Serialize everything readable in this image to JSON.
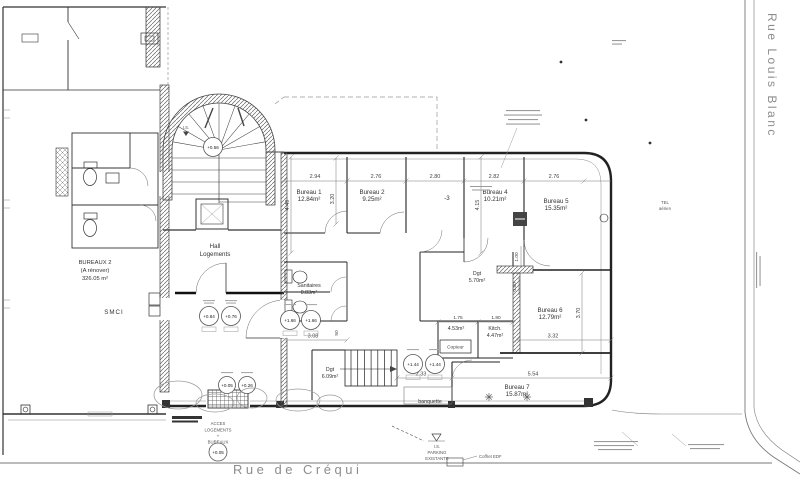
{
  "plan": {
    "streets": {
      "right": "Rue Louis Blanc",
      "bottom": "Rue de Créqui"
    },
    "rooms": {
      "bureau1": {
        "name": "Bureau 1",
        "area": "12.84m²"
      },
      "bureau2": {
        "name": "Bureau 2",
        "area": "9.25m²"
      },
      "bureau3": {
        "name": "-3"
      },
      "bureau4": {
        "name": "Bureau 4",
        "area": "10.21m²"
      },
      "bureau5": {
        "name": "Bureau 5",
        "area": "15.35m²"
      },
      "bureau6": {
        "name": "Bureau 6",
        "area": "12.79m²"
      },
      "bureau7": {
        "name": "Bureau 7",
        "area": "15.87m²"
      },
      "hall": {
        "name": "Hall",
        "name2": "Logements"
      },
      "bureaux2": {
        "name": "BUREAUX 2",
        "status": "(A rénover)",
        "area": "326.05 m²"
      },
      "smci": {
        "name": "SMCI"
      },
      "sanitaires": {
        "name": "Sanitaires",
        "area": "8.83m²"
      },
      "dgt_upper": {
        "name": "Dgt",
        "area": "5.70m²"
      },
      "dgt_lower": {
        "name": "Dgt",
        "area": "6.09m²"
      },
      "kitch": {
        "name": "Kitch.",
        "area": "4.47m²"
      },
      "storage": {
        "area": "4.53m²"
      },
      "copieur": {
        "name": "Copieur"
      },
      "banquette": {
        "name": "banquette"
      }
    },
    "entrance": {
      "l1": "ACCES",
      "l2": "LOGEMENTS",
      "l3": "+",
      "l4": "BUREAUX"
    },
    "parking": {
      "l1": "I.S.",
      "l2": "PARKING",
      "l3": "EXISTANTE"
    },
    "notes": {
      "is": "I.S.",
      "tel1": "TEL",
      "tel2": "aérien",
      "coffret": "Coffret EDF"
    },
    "dims": {
      "top": [
        "2.94",
        "2.76",
        "2.80",
        "2.82",
        "2.76"
      ],
      "v449": "4.49",
      "v320": "3.20",
      "v415": "4.15",
      "v100": "1.00",
      "v080": "0.80",
      "v370": "3.70",
      "h175": "1.75",
      "h180": "1.80",
      "h308": "3.08",
      "h332": "3.32",
      "h233": "2.33",
      "h554": "5.54",
      "h50": "50"
    },
    "levels": {
      "stair": "+0.56",
      "hallA": "+0.84",
      "hallB": "+0.76",
      "sanA": "+1.66",
      "sanB": "+1.66",
      "stairA": "+1.44",
      "stairB": "+1.44",
      "entA": "+0.05",
      "entB": "+0.26",
      "street": "+0.05"
    },
    "colors": {
      "line": "#333333",
      "thin": "#777777",
      "street_text": "#8d8d8d"
    }
  }
}
